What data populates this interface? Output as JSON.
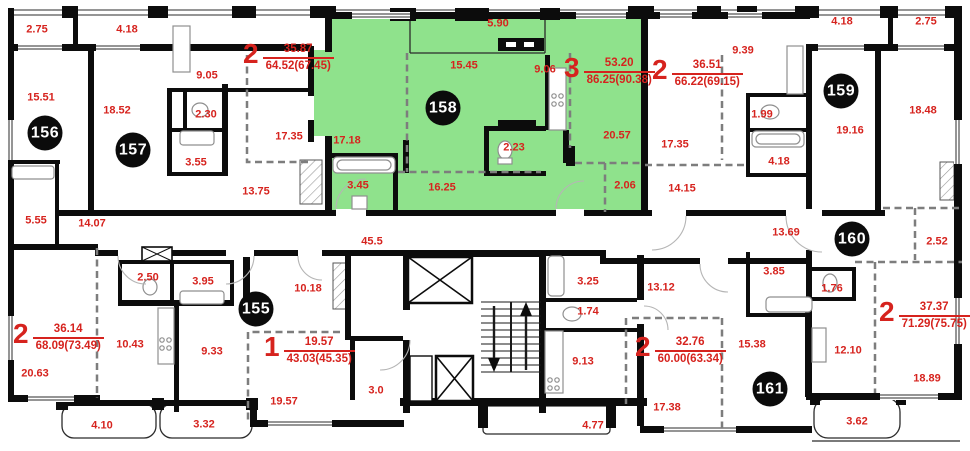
{
  "plan_title": "Residential floor plan, units 155-161",
  "colors": {
    "highlight_green": "#8fe28c",
    "label_red": "#d6231e",
    "wall_black": "#0c0c0c",
    "partition_gray": "#7d7d7d",
    "badge_black": "#0b0b0b",
    "badge_text": "#ffffff"
  },
  "highlighted_unit": "158",
  "units": [
    {
      "id": "155",
      "x": 256,
      "y": 309
    },
    {
      "id": "156",
      "x": 45,
      "y": 133
    },
    {
      "id": "157",
      "x": 133,
      "y": 150
    },
    {
      "id": "158",
      "x": 443,
      "y": 108
    },
    {
      "id": "159",
      "x": 841,
      "y": 91
    },
    {
      "id": "160",
      "x": 852,
      "y": 239
    },
    {
      "id": "161",
      "x": 770,
      "y": 389
    }
  ],
  "apartments": [
    {
      "rooms": "2",
      "living": "35.87",
      "total": "64.52(67.45)",
      "x": 243,
      "y": 42
    },
    {
      "rooms": "3",
      "living": "53.20",
      "total": "86.25(90.38)",
      "x": 564,
      "y": 56
    },
    {
      "rooms": "2",
      "living": "36.51",
      "total": "66.22(69.15)",
      "x": 652,
      "y": 58
    },
    {
      "rooms": "2",
      "living": "36.14",
      "total": "68.09(73.49)",
      "x": 13,
      "y": 322
    },
    {
      "rooms": "1",
      "living": "19.57",
      "total": "43.03(45.35)",
      "x": 264,
      "y": 335
    },
    {
      "rooms": "2",
      "living": "32.76",
      "total": "60.00(63.34)",
      "x": 635,
      "y": 335
    },
    {
      "rooms": "2",
      "living": "37.37",
      "total": "71.29(75.75)",
      "x": 879,
      "y": 300
    }
  ],
  "room_labels": [
    {
      "text": "2.75",
      "x": 37,
      "y": 30
    },
    {
      "text": "4.18",
      "x": 127,
      "y": 30
    },
    {
      "text": "15.51",
      "x": 41,
      "y": 98
    },
    {
      "text": "18.52",
      "x": 117,
      "y": 111
    },
    {
      "text": "9.05",
      "x": 207,
      "y": 76
    },
    {
      "text": "2.30",
      "x": 206,
      "y": 115
    },
    {
      "text": "3.55",
      "x": 196,
      "y": 163
    },
    {
      "text": "17.35",
      "x": 289,
      "y": 137
    },
    {
      "text": "13.75",
      "x": 256,
      "y": 192
    },
    {
      "text": "5.55",
      "x": 36,
      "y": 221
    },
    {
      "text": "14.07",
      "x": 92,
      "y": 224
    },
    {
      "text": "17.18",
      "x": 347,
      "y": 141
    },
    {
      "text": "3.45",
      "x": 358,
      "y": 186
    },
    {
      "text": "16.25",
      "x": 442,
      "y": 188
    },
    {
      "text": "5.90",
      "x": 498,
      "y": 24
    },
    {
      "text": "15.45",
      "x": 464,
      "y": 66
    },
    {
      "text": "9.06",
      "x": 545,
      "y": 70
    },
    {
      "text": "2.23",
      "x": 514,
      "y": 148
    },
    {
      "text": "20.57",
      "x": 617,
      "y": 136
    },
    {
      "text": "2.06",
      "x": 625,
      "y": 186
    },
    {
      "text": "9.39",
      "x": 743,
      "y": 51
    },
    {
      "text": "1.99",
      "x": 762,
      "y": 115
    },
    {
      "text": "17.35",
      "x": 675,
      "y": 145
    },
    {
      "text": "4.18",
      "x": 779,
      "y": 162
    },
    {
      "text": "14.15",
      "x": 682,
      "y": 189
    },
    {
      "text": "4.18",
      "x": 842,
      "y": 22
    },
    {
      "text": "2.75",
      "x": 926,
      "y": 22
    },
    {
      "text": "19.16",
      "x": 850,
      "y": 131
    },
    {
      "text": "18.48",
      "x": 923,
      "y": 111
    },
    {
      "text": "13.69",
      "x": 786,
      "y": 233
    },
    {
      "text": "2.52",
      "x": 937,
      "y": 242
    },
    {
      "text": "3.85",
      "x": 774,
      "y": 272
    },
    {
      "text": "1.76",
      "x": 832,
      "y": 289
    },
    {
      "text": "13.12",
      "x": 661,
      "y": 288
    },
    {
      "text": "12.10",
      "x": 848,
      "y": 351
    },
    {
      "text": "18.89",
      "x": 927,
      "y": 379
    },
    {
      "text": "15.38",
      "x": 752,
      "y": 345
    },
    {
      "text": "17.38",
      "x": 667,
      "y": 408
    },
    {
      "text": "3.62",
      "x": 857,
      "y": 422
    },
    {
      "text": "45.5",
      "x": 372,
      "y": 242
    },
    {
      "text": "3.25",
      "x": 588,
      "y": 282
    },
    {
      "text": "1.74",
      "x": 588,
      "y": 312
    },
    {
      "text": "9.13",
      "x": 583,
      "y": 362
    },
    {
      "text": "3.0",
      "x": 376,
      "y": 391
    },
    {
      "text": "4.77",
      "x": 593,
      "y": 426
    },
    {
      "text": "2.50",
      "x": 148,
      "y": 278
    },
    {
      "text": "3.95",
      "x": 203,
      "y": 282
    },
    {
      "text": "10.18",
      "x": 308,
      "y": 289
    },
    {
      "text": "10.43",
      "x": 130,
      "y": 345
    },
    {
      "text": "9.33",
      "x": 212,
      "y": 352
    },
    {
      "text": "20.63",
      "x": 35,
      "y": 374
    },
    {
      "text": "19.57",
      "x": 284,
      "y": 402
    },
    {
      "text": "4.10",
      "x": 102,
      "y": 426
    },
    {
      "text": "3.32",
      "x": 204,
      "y": 425
    }
  ]
}
